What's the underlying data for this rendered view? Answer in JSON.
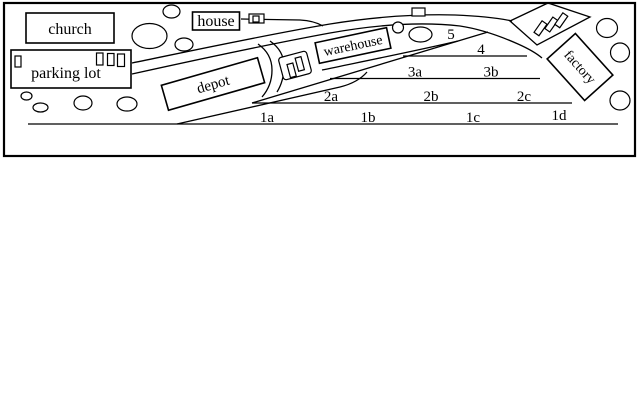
{
  "diagram_title": "rail yard track plan sketch",
  "colors": {
    "ink": "#000000",
    "paper": "#ffffff"
  },
  "buildings": {
    "church": "church",
    "house": "house",
    "parking_lot": "parking lot",
    "depot": "depot",
    "warehouse": "warehouse",
    "factory": "factory"
  },
  "tracks": {
    "t5": "5",
    "t4": "4",
    "t3a": "3a",
    "t3b": "3b",
    "t2a": "2a",
    "t2b": "2b",
    "t2c": "2c",
    "t1a": "1a",
    "t1b": "1b",
    "t1c": "1c",
    "t1d": "1d"
  }
}
